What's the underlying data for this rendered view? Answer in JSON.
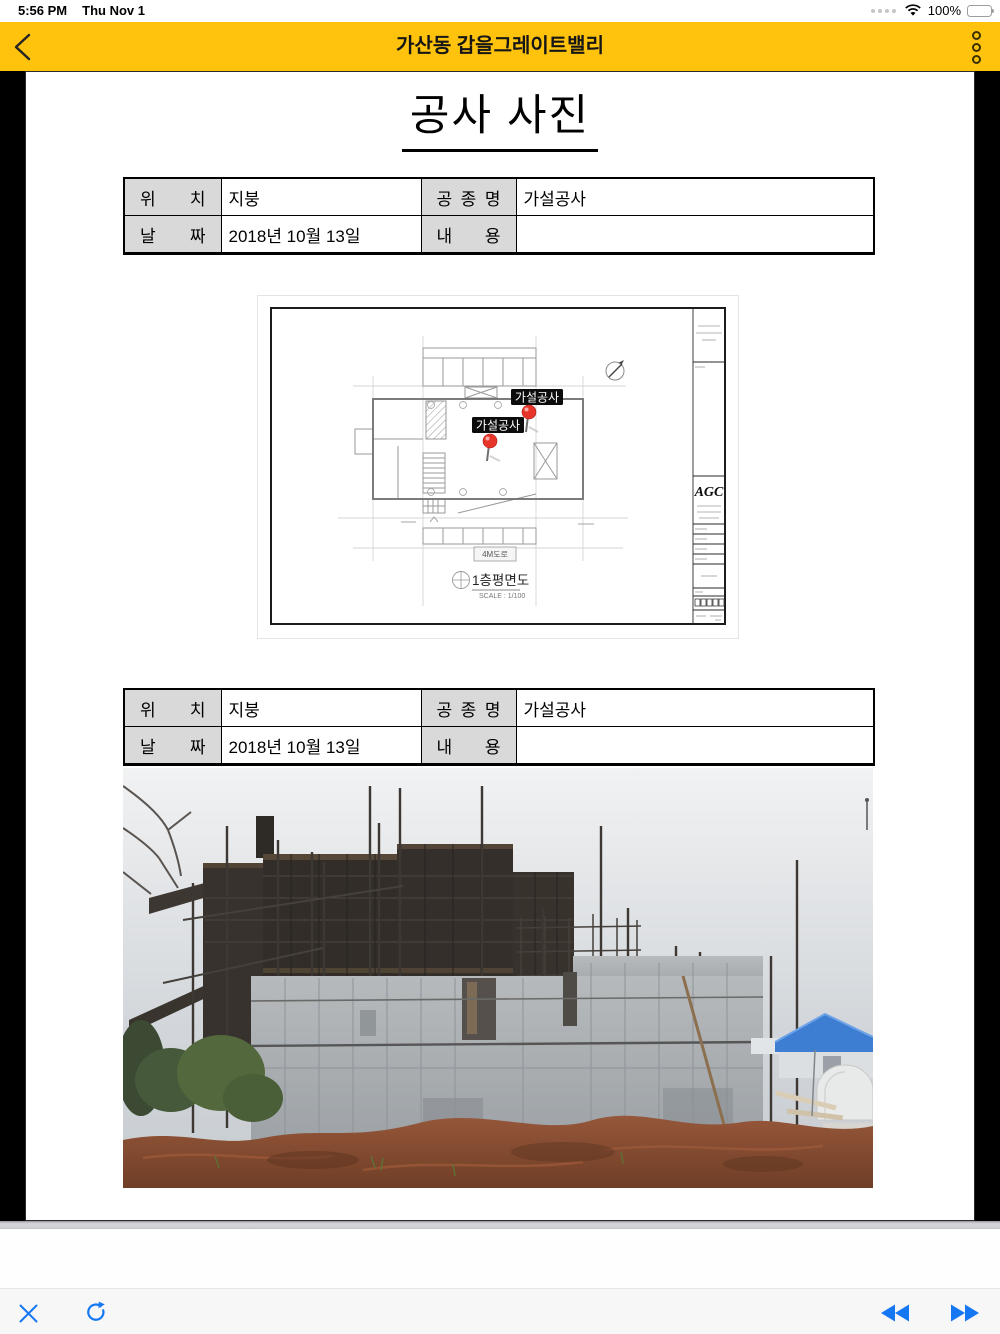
{
  "status_bar": {
    "time": "5:56 PM",
    "date": "Thu Nov 1",
    "battery_percent": "100%"
  },
  "nav_bar": {
    "title": "가산동 갑을그레이트밸리"
  },
  "document": {
    "title": "공사 사진",
    "tables": [
      {
        "rows": [
          {
            "h1": "위 치",
            "v1": "지붕",
            "h2": "공 종 명",
            "v2": "가설공사"
          },
          {
            "h1": "날 짜",
            "v1": "2018년 10월 13일",
            "h2": "내 용",
            "v2": ""
          }
        ]
      },
      {
        "rows": [
          {
            "h1": "위 치",
            "v1": "지붕",
            "h2": "공 종 명",
            "v2": "가설공사"
          },
          {
            "h1": "날 짜",
            "v1": "2018년 10월 13일",
            "h2": "내 용",
            "v2": ""
          }
        ]
      }
    ],
    "plan": {
      "pins": [
        "가설공사",
        "가설공사"
      ],
      "road_label": "4M도로",
      "caption": "1층평면도",
      "scale_label": "SCALE : 1/100",
      "title_block_logo": "AGC"
    }
  },
  "colors": {
    "nav_yellow": "#FFC20D",
    "toolbar_blue": "#1677F3",
    "table_header_gray": "#D9D9D9",
    "pin_red": "#E8352A",
    "doc_background": "#000000"
  }
}
